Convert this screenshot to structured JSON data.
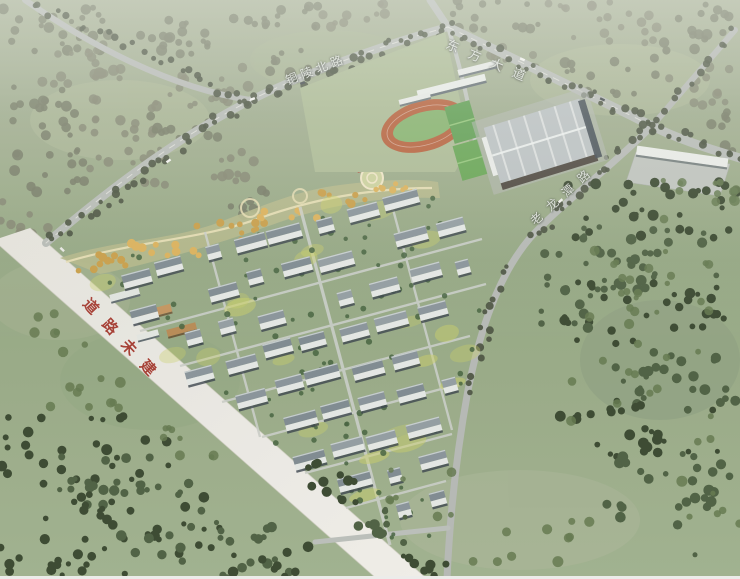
{
  "labels": {
    "north_road": "铜陵北路",
    "east_avenue": "东方大道",
    "east_road": "老龙潭路",
    "unbuilt_road": "道路未建"
  },
  "colors": {
    "unbuilt_road_text": "#9e2b20",
    "field_green": "#97a886",
    "forest_green": "#36452d",
    "road_gray": "#b4b8b4",
    "unbuilt_road_surface": "#edebe6",
    "running_track": "#b25934",
    "sports_court": "#57994a",
    "building_facade": "#e3e7e4",
    "building_roof": "#848f96",
    "park_tree_orange": "#c69a40"
  }
}
